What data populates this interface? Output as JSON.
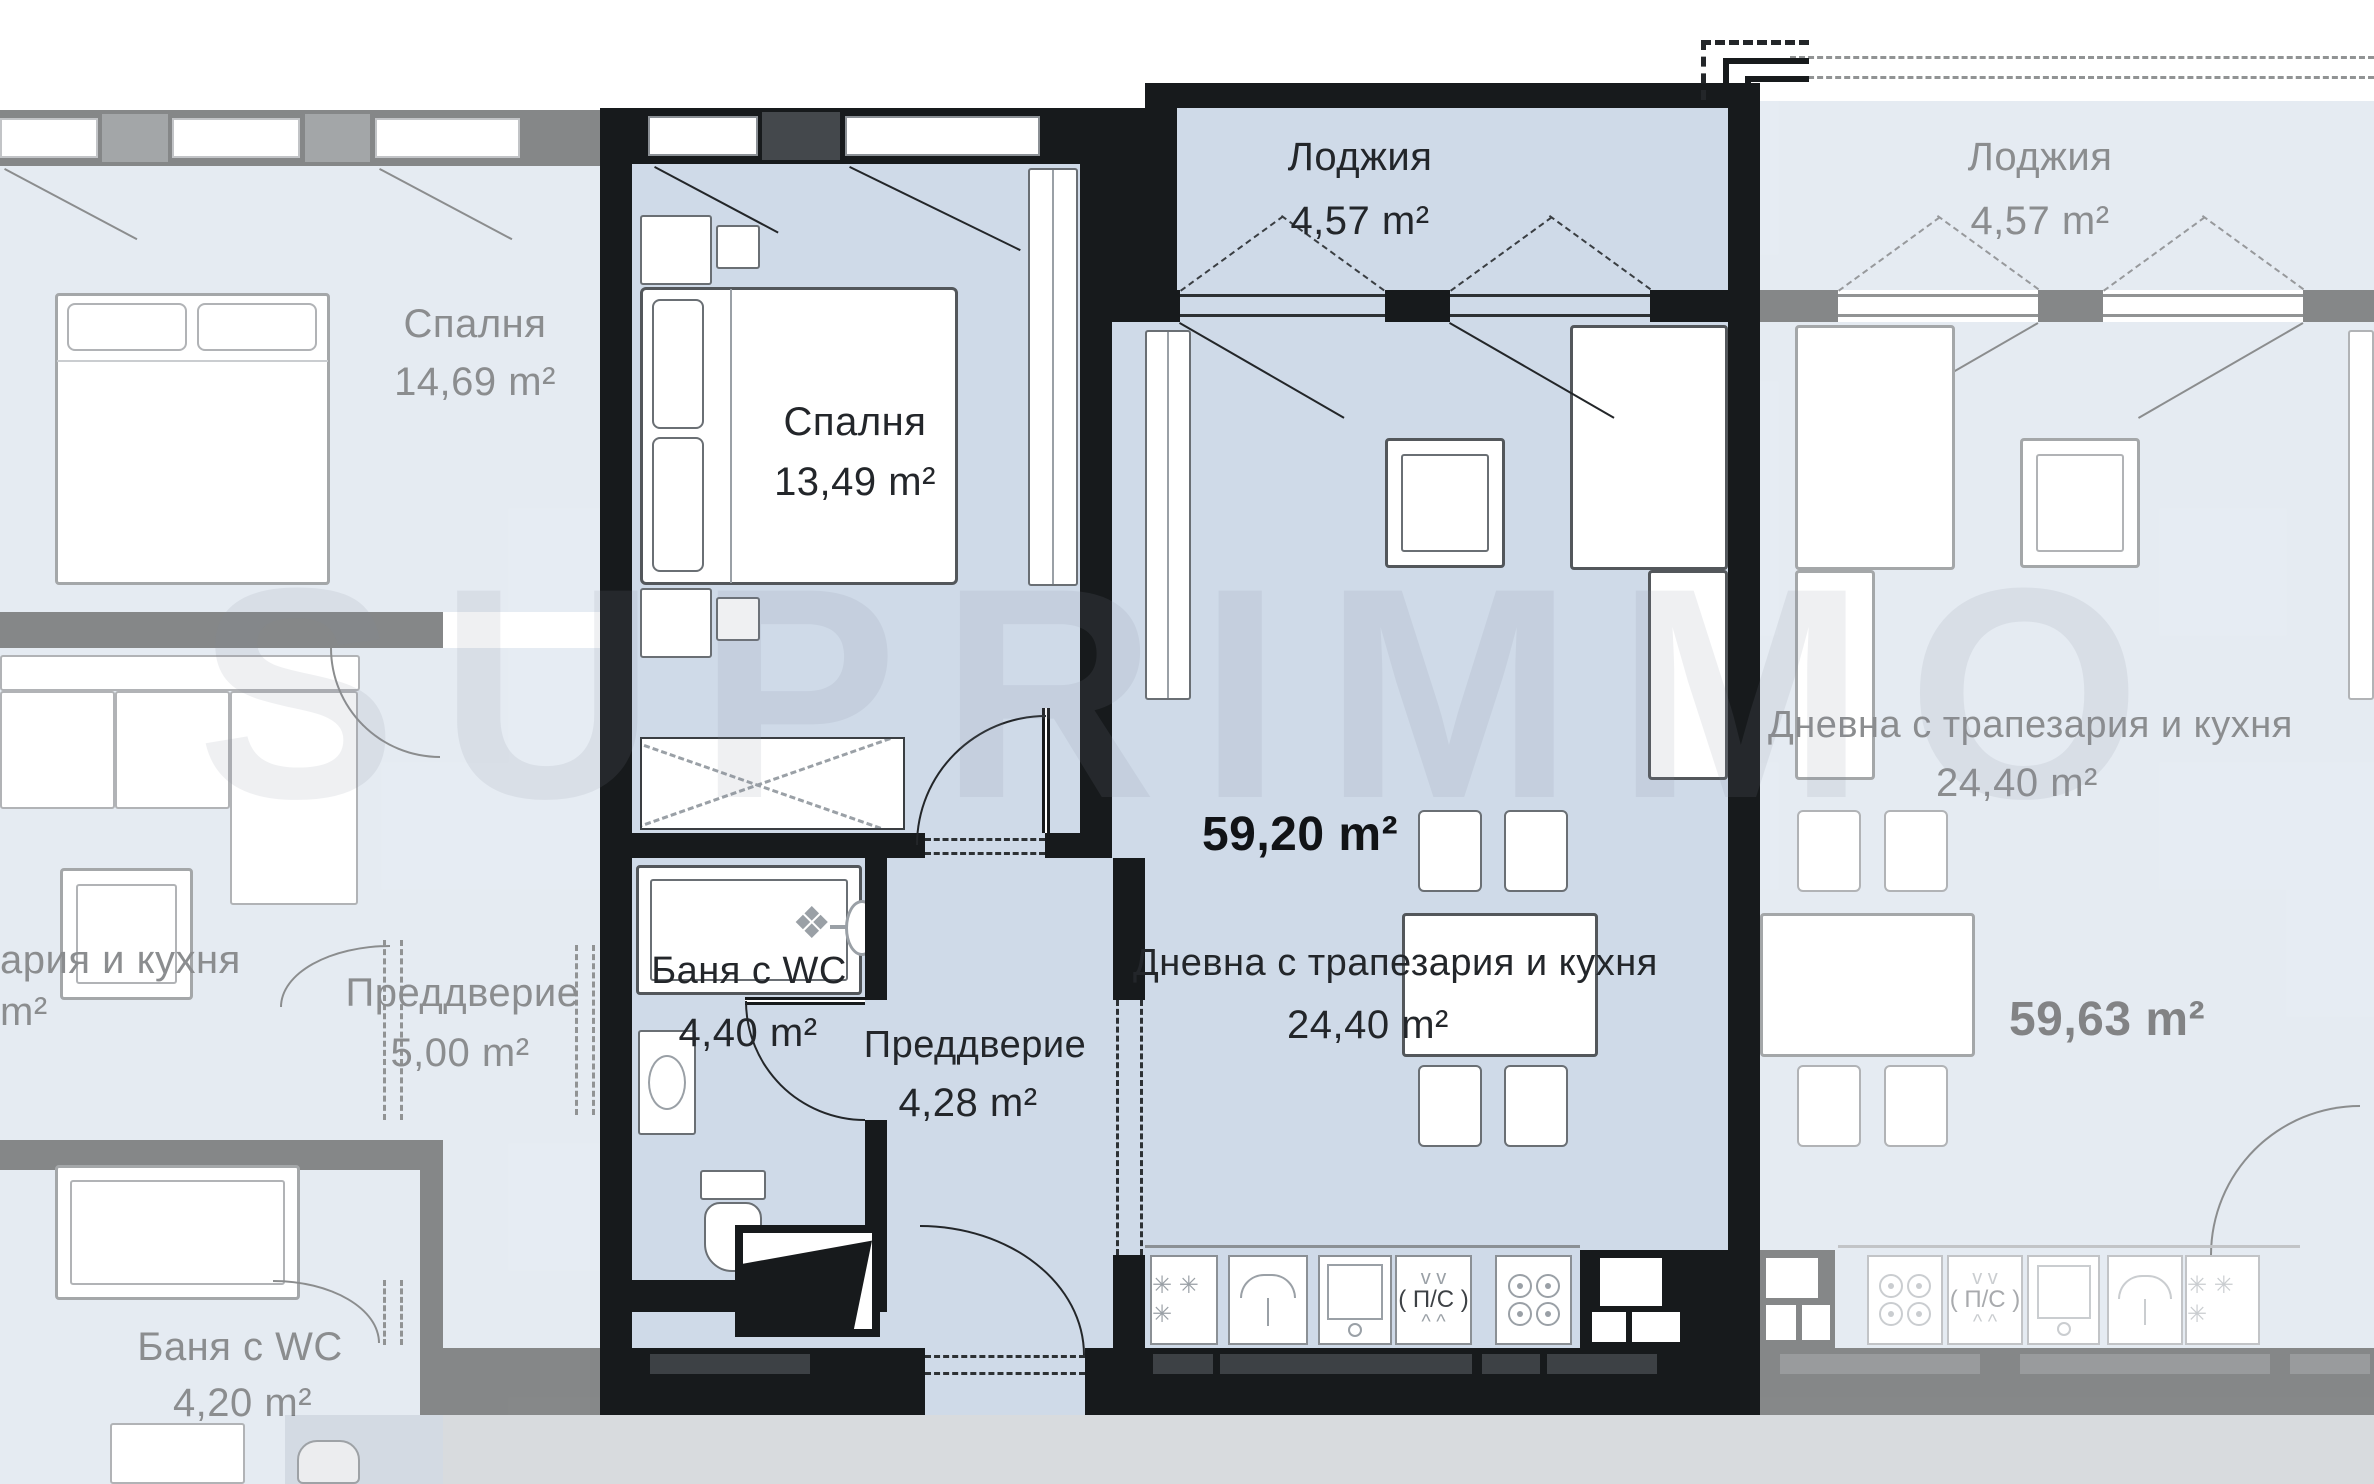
{
  "watermark": "SUPRIMMO",
  "main_apartment": {
    "total_area": "59,20 m²",
    "loggia": {
      "name": "Лоджия",
      "area": "4,57 m²"
    },
    "bedroom": {
      "name": "Спалня",
      "area": "13,49 m²"
    },
    "living": {
      "name": "Дневна с трапезария и кухня",
      "area": "24,40 m²"
    },
    "bathroom": {
      "name": "Баня с WC",
      "area": "4,40 m²"
    },
    "hall": {
      "name": "Преддверие",
      "area": "4,28 m²"
    },
    "kitchen": {
      "stove_label": "( П/С )"
    }
  },
  "left_apartment": {
    "bedroom": {
      "name": "Спалня",
      "area": "14,69 m²"
    },
    "living_fragment": {
      "name": "ария и кухня",
      "area": "m²"
    },
    "hall": {
      "name": "Преддверие",
      "area": "5,00 m²"
    },
    "bathroom": {
      "name": "Баня с WC",
      "area": "4,20 m²"
    }
  },
  "right_apartment": {
    "total_area": "59,63 m²",
    "loggia": {
      "name": "Лоджия",
      "area": "4,57 m²"
    },
    "living": {
      "name": "Дневна с трапезария и кухня",
      "area": "24,40 m²"
    },
    "kitchen": {
      "stove_label": "( П/С )"
    }
  },
  "icons": {
    "freezer": "✳ ✳ ✳",
    "vent_top": "v   v",
    "vent_bottom": "^   ^",
    "shower_valve": "❖"
  },
  "colors": {
    "floor_blue": "#cfdae8",
    "wall_black": "#171a1c",
    "faded_text": "#98a2ac",
    "gray_strip": "#d8dbde"
  }
}
